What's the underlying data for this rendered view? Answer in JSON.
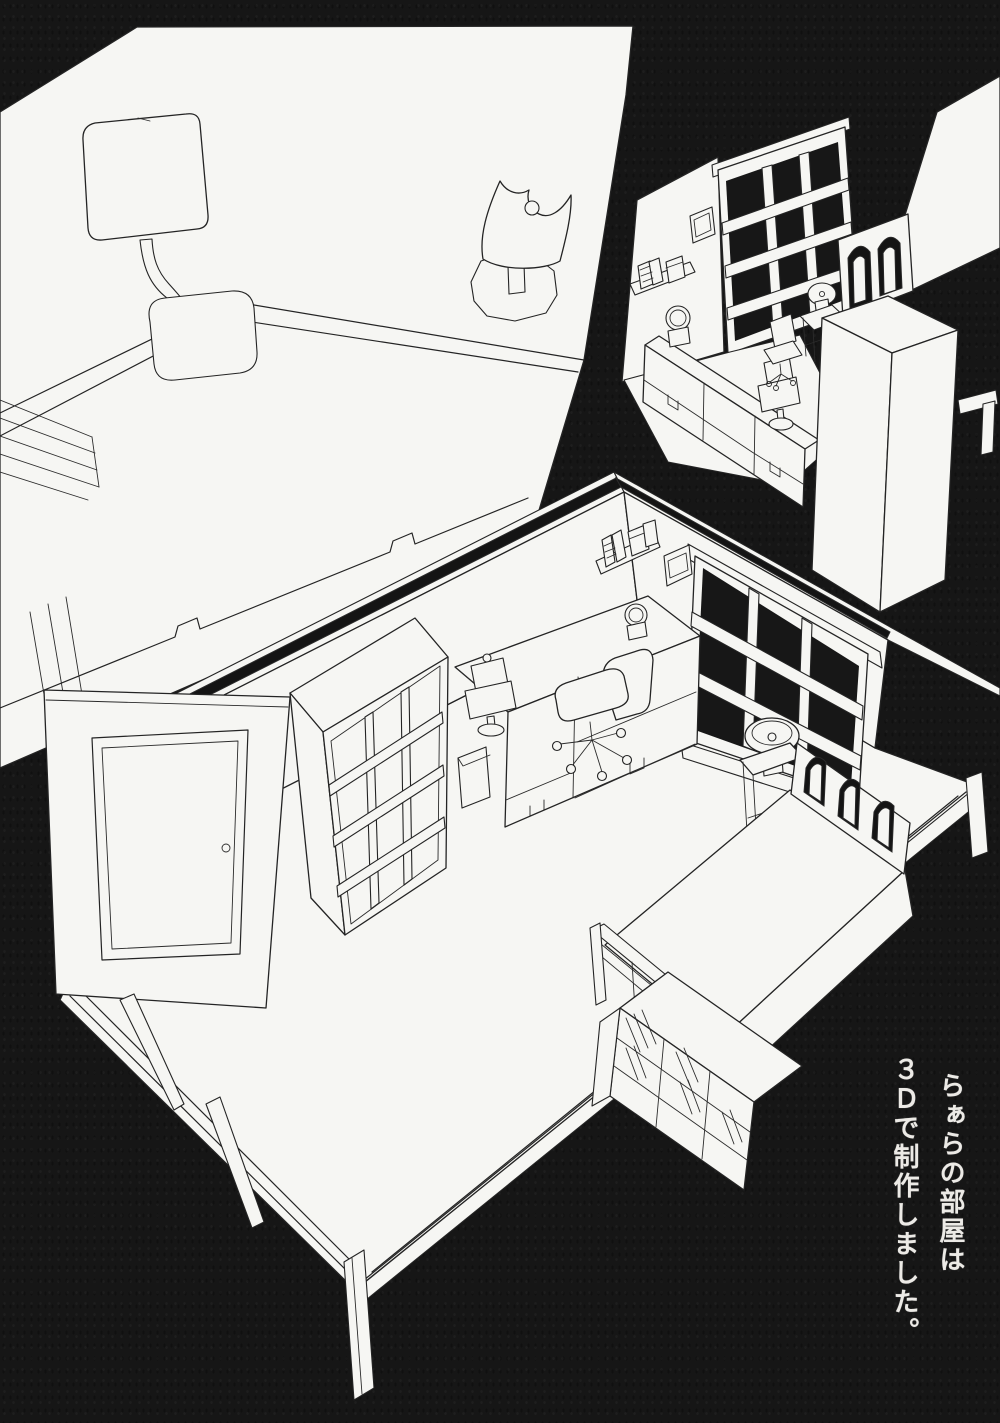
{
  "caption": {
    "line1": "らぁらの部屋は",
    "line2": "３Ｄで制作しました。"
  },
  "colors": {
    "background": "#161616",
    "paper": "#f6f6f3",
    "ink": "#242424",
    "caption_text": "#eceae6"
  },
  "artwork": {
    "description_visible_content": "three white line-art 3D wireframe views of a room on black",
    "views": [
      "closeup-desk-view",
      "small-overview-room",
      "main-room"
    ]
  }
}
